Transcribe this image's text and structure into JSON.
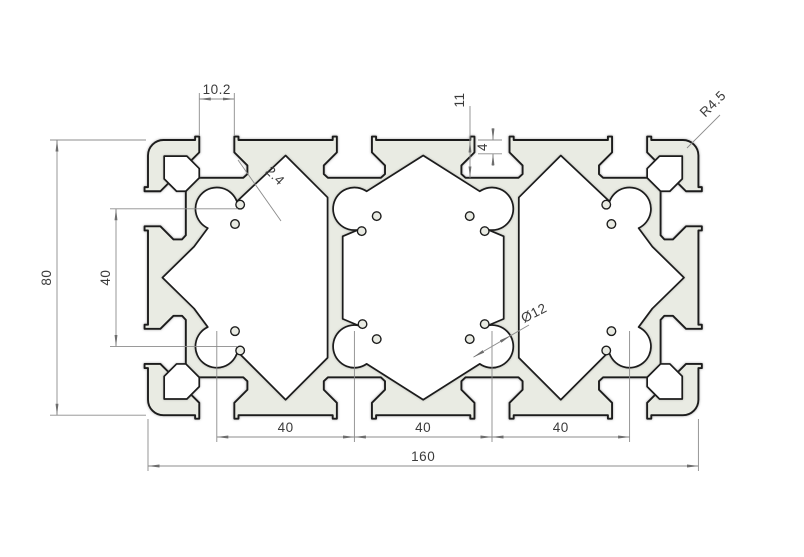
{
  "drawing": {
    "type": "technical-section-drawing",
    "units_shown": "mm",
    "profile_fill": "#e9ebe3",
    "outline_color": "#1c1c1c",
    "dimension_color": "#8c8c8c",
    "text_color": "#3b3b3b",
    "background": "#ffffff"
  },
  "dimensions": {
    "slot_opening_width": "10.2",
    "wall_thickness": "2.4",
    "slot_depth": "11",
    "slot_lip_height": "4",
    "corner_radius": "R4.5",
    "overall_height": "80",
    "vertical_pitch": "40",
    "bore_diameter": "Ø12",
    "bottom_pitch_1": "40",
    "bottom_pitch_2": "40",
    "bottom_pitch_3": "40",
    "overall_width": "160"
  }
}
